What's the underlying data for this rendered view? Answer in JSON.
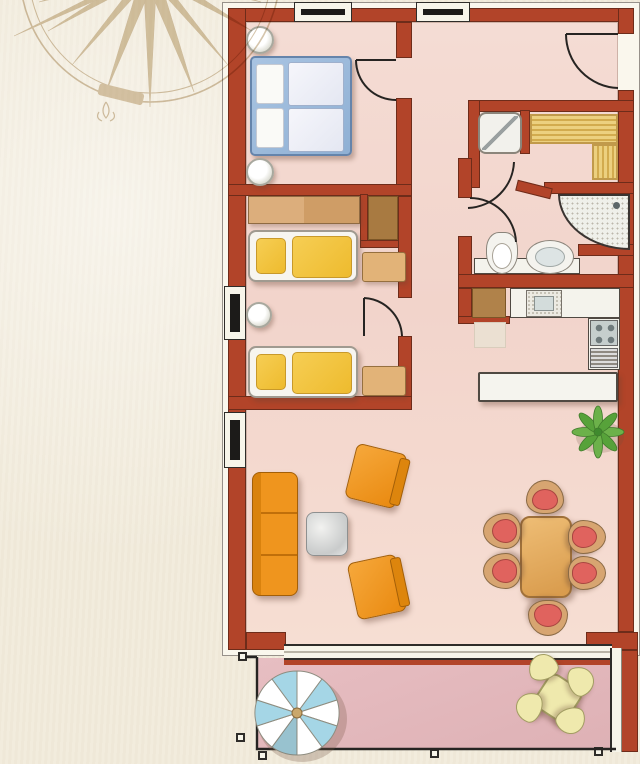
{
  "palette": {
    "wall": "#b24429",
    "floor": "#f3d8d0",
    "terrace": "#e3b7ba",
    "paper": "#f2ecdd",
    "orange": "#ef951e",
    "yellow": "#f2c544",
    "bedblue": "#9cb9d9",
    "wood": "#d7a571",
    "closet": "#a87a41",
    "chairred": "#e0635e",
    "plantgreen": "#68b148",
    "pale": "#efe9ad",
    "umbrellablue": "#a5d6e6",
    "silver": "#d9dadb",
    "compass": "#c0a678"
  },
  "items": [
    {
      "n": "plan-mat",
      "t": "mat",
      "x": 222,
      "y": 2,
      "w": 418,
      "h": 654
    },
    {
      "n": "main-floor",
      "t": "floor",
      "x": 246,
      "y": 22,
      "w": 372,
      "h": 626
    },
    {
      "n": "terrace-floor",
      "t": "terrace",
      "x": 256,
      "y": 658,
      "w": 358,
      "h": 92
    },
    {
      "n": "top-wall",
      "t": "wall",
      "x": 228,
      "y": 8,
      "w": 406,
      "h": 14
    },
    {
      "n": "left-wall",
      "t": "wall",
      "x": 228,
      "y": 8,
      "w": 18,
      "h": 642
    },
    {
      "n": "right-wall-top",
      "t": "wall",
      "x": 618,
      "y": 8,
      "w": 16,
      "h": 26
    },
    {
      "n": "right-wall",
      "t": "wall",
      "x": 618,
      "y": 90,
      "w": 16,
      "h": 542
    },
    {
      "n": "bottom-wall-left",
      "t": "wall",
      "x": 246,
      "y": 632,
      "w": 40,
      "h": 18
    },
    {
      "n": "bottom-wall-right",
      "t": "wall",
      "x": 586,
      "y": 632,
      "w": 52,
      "h": 18
    },
    {
      "n": "terrace-right-wall",
      "t": "wall",
      "x": 620,
      "y": 650,
      "w": 18,
      "h": 102
    },
    {
      "n": "bedroom1-right-wall-a",
      "t": "wall",
      "x": 396,
      "y": 22,
      "w": 16,
      "h": 36
    },
    {
      "n": "bedroom1-right-wall-b",
      "t": "wall",
      "x": 396,
      "y": 98,
      "w": 16,
      "h": 90
    },
    {
      "n": "bedroom-divider-wall",
      "t": "wall",
      "x": 228,
      "y": 184,
      "w": 184,
      "h": 12
    },
    {
      "n": "closet-wall-left",
      "t": "wall",
      "x": 360,
      "y": 194,
      "w": 8,
      "h": 54
    },
    {
      "n": "closet-wall-bottom",
      "t": "wall",
      "x": 360,
      "y": 240,
      "w": 50,
      "h": 8
    },
    {
      "n": "bedroom2-right-wall-a",
      "t": "wall",
      "x": 398,
      "y": 196,
      "w": 14,
      "h": 102
    },
    {
      "n": "bedroom2-right-wall-b",
      "t": "wall",
      "x": 398,
      "y": 336,
      "w": 14,
      "h": 62
    },
    {
      "n": "bedroom-bottom-wall",
      "t": "wall",
      "x": 228,
      "y": 396,
      "w": 184,
      "h": 14
    },
    {
      "n": "sauna-top-wall",
      "t": "wall",
      "x": 468,
      "y": 100,
      "w": 166,
      "h": 12
    },
    {
      "n": "sauna-left-wall",
      "t": "wall",
      "x": 468,
      "y": 100,
      "w": 12,
      "h": 88
    },
    {
      "n": "sauna-niche-wall",
      "t": "wall",
      "x": 520,
      "y": 110,
      "w": 10,
      "h": 44
    },
    {
      "n": "sauna-bottom-wall",
      "t": "wall",
      "x": 544,
      "y": 182,
      "w": 90,
      "h": 12
    },
    {
      "n": "sauna-diagonal-wall",
      "t": "wall",
      "x": 516,
      "y": 184,
      "w": 36,
      "h": 11,
      "r": 14
    },
    {
      "n": "bath-left-wall-a",
      "t": "wall",
      "x": 458,
      "y": 158,
      "w": 14,
      "h": 40
    },
    {
      "n": "bath-left-wall-b",
      "t": "wall",
      "x": 458,
      "y": 236,
      "w": 14,
      "h": 52
    },
    {
      "n": "shower-stub-wall",
      "t": "wall",
      "x": 578,
      "y": 244,
      "w": 56,
      "h": 12
    },
    {
      "n": "bath-bottom-wall",
      "t": "wall",
      "x": 458,
      "y": 274,
      "w": 176,
      "h": 14
    },
    {
      "n": "kitchen-left-wall",
      "t": "wall",
      "x": 458,
      "y": 288,
      "w": 14,
      "h": 36
    },
    {
      "n": "kitchen-stub-wall",
      "t": "wall",
      "x": 458,
      "y": 316,
      "w": 52,
      "h": 8
    },
    {
      "n": "top-window-1",
      "t": "winh",
      "x": 294,
      "y": 2,
      "w": 58,
      "h": 20
    },
    {
      "n": "top-window-2",
      "t": "winh",
      "x": 416,
      "y": 2,
      "w": 54,
      "h": 20
    },
    {
      "n": "left-window-1",
      "t": "winv",
      "x": 224,
      "y": 286,
      "w": 22,
      "h": 54
    },
    {
      "n": "left-window-2",
      "t": "winv",
      "x": 224,
      "y": 412,
      "w": 22,
      "h": 56
    },
    {
      "n": "patio-door-threshold",
      "t": "thresh",
      "x": 284,
      "y": 644,
      "w": 328,
      "h": 16
    },
    {
      "n": "patio-door-redline",
      "t": "redline",
      "x": 284,
      "y": 660,
      "w": 332,
      "h": 5
    },
    {
      "n": "terrace-white-strip",
      "t": "wstrip",
      "x": 610,
      "y": 648,
      "w": 12,
      "h": 104
    },
    {
      "n": "railing-post",
      "t": "post",
      "x": 238,
      "y": 652,
      "w": 9,
      "h": 9
    },
    {
      "n": "railing-post",
      "t": "post",
      "x": 236,
      "y": 733,
      "w": 9,
      "h": 9
    },
    {
      "n": "railing-post",
      "t": "post",
      "x": 258,
      "y": 751,
      "w": 9,
      "h": 9
    },
    {
      "n": "railing-post",
      "t": "post",
      "x": 430,
      "y": 749,
      "w": 9,
      "h": 9
    },
    {
      "n": "railing-post",
      "t": "post",
      "x": 594,
      "y": 747,
      "w": 9,
      "h": 9
    },
    {
      "n": "nightstand-lamp-1",
      "t": "lamp",
      "x": 246,
      "y": 26,
      "w": 28,
      "h": 28
    },
    {
      "n": "double-bed",
      "t": "bed",
      "x": 250,
      "y": 56,
      "w": 102,
      "h": 100
    },
    {
      "n": "bed-pillow-1",
      "t": "pillow",
      "x": 256,
      "y": 64,
      "w": 28,
      "h": 40
    },
    {
      "n": "bed-pillow-2",
      "t": "pillow",
      "x": 256,
      "y": 108,
      "w": 28,
      "h": 40
    },
    {
      "n": "bed-duvet-1",
      "t": "duvetw",
      "x": 288,
      "y": 62,
      "w": 56,
      "h": 44
    },
    {
      "n": "bed-duvet-2",
      "t": "duvetw",
      "x": 288,
      "y": 108,
      "w": 56,
      "h": 44
    },
    {
      "n": "nightstand-lamp-2",
      "t": "lamp",
      "x": 246,
      "y": 158,
      "w": 28,
      "h": 28
    },
    {
      "n": "wardrobe",
      "t": "wood",
      "x": 248,
      "y": 196,
      "w": 112,
      "h": 28
    },
    {
      "n": "builtin-closet",
      "t": "closet",
      "x": 368,
      "y": 196,
      "w": 30,
      "h": 44
    },
    {
      "n": "single-bed-1",
      "t": "bedbase",
      "x": 248,
      "y": 230,
      "w": 110,
      "h": 52
    },
    {
      "n": "single-bed-1-pillow",
      "t": "duvy",
      "x": 256,
      "y": 238,
      "w": 30,
      "h": 36
    },
    {
      "n": "single-bed-1-duvet",
      "t": "duvy",
      "x": 292,
      "y": 236,
      "w": 60,
      "h": 42
    },
    {
      "n": "bench-1",
      "t": "bench",
      "x": 362,
      "y": 252,
      "w": 44,
      "h": 30
    },
    {
      "n": "round-stool",
      "t": "stool",
      "x": 246,
      "y": 302,
      "w": 26,
      "h": 26
    },
    {
      "n": "single-bed-2",
      "t": "bedbase",
      "x": 248,
      "y": 346,
      "w": 110,
      "h": 52
    },
    {
      "n": "single-bed-2-pillow",
      "t": "duvy",
      "x": 256,
      "y": 354,
      "w": 30,
      "h": 36
    },
    {
      "n": "single-bed-2-duvet",
      "t": "duvy",
      "x": 292,
      "y": 352,
      "w": 60,
      "h": 42
    },
    {
      "n": "bench-2",
      "t": "bench",
      "x": 362,
      "y": 366,
      "w": 44,
      "h": 30
    },
    {
      "n": "sauna-shower",
      "t": "showersq",
      "x": 478,
      "y": 112,
      "w": 44,
      "h": 42
    },
    {
      "n": "sauna-bench-top",
      "t": "sbenchh",
      "x": 530,
      "y": 114,
      "w": 88,
      "h": 30
    },
    {
      "n": "sauna-bench-right",
      "t": "sbenchv",
      "x": 592,
      "y": 144,
      "w": 26,
      "h": 36
    },
    {
      "n": "bath-counter",
      "t": "counter",
      "x": 474,
      "y": 258,
      "w": 106,
      "h": 16
    },
    {
      "n": "corner-shower",
      "t": "cshower",
      "x": 558,
      "y": 194,
      "w": 72,
      "h": 56
    },
    {
      "n": "toilet",
      "t": "toilet",
      "x": 486,
      "y": 232,
      "w": 32,
      "h": 42
    },
    {
      "n": "washbasin",
      "t": "sinko",
      "x": 526,
      "y": 240,
      "w": 48,
      "h": 34
    },
    {
      "n": "fridge",
      "t": "fridge",
      "x": 472,
      "y": 288,
      "w": 34,
      "h": 30
    },
    {
      "n": "kitchen-rug",
      "t": "rug",
      "x": 474,
      "y": 322,
      "w": 32,
      "h": 26
    },
    {
      "n": "kitchen-counter",
      "t": "counter",
      "x": 510,
      "y": 288,
      "w": 110,
      "h": 30
    },
    {
      "n": "kitchen-sink",
      "t": "speckle",
      "x": 526,
      "y": 290,
      "w": 36,
      "h": 27
    },
    {
      "n": "kitchen-unit",
      "t": "counter",
      "x": 588,
      "y": 318,
      "w": 32,
      "h": 52
    },
    {
      "n": "stove",
      "t": "stove",
      "x": 590,
      "y": 320,
      "w": 28,
      "h": 26
    },
    {
      "n": "oven",
      "t": "striped",
      "x": 590,
      "y": 348,
      "w": 28,
      "h": 20
    },
    {
      "n": "kitchen-island",
      "t": "island",
      "x": 478,
      "y": 372,
      "w": 140,
      "h": 30
    },
    {
      "n": "sofa",
      "t": "sofa",
      "x": 252,
      "y": 472,
      "w": 46,
      "h": 124
    },
    {
      "n": "coffee-table",
      "t": "ctable",
      "x": 306,
      "y": 512,
      "w": 42,
      "h": 44
    },
    {
      "n": "armchair-1",
      "t": "armchair",
      "x": 350,
      "y": 448,
      "w": 52,
      "h": 56,
      "r": 14
    },
    {
      "n": "armchair-2",
      "t": "armchair",
      "x": 352,
      "y": 558,
      "w": 50,
      "h": 58,
      "r": -12
    },
    {
      "n": "dining-table",
      "t": "dtable",
      "x": 520,
      "y": 516,
      "w": 52,
      "h": 82
    },
    {
      "n": "dining-chair-north",
      "t": "chair",
      "x": 526,
      "y": 480,
      "w": 38,
      "h": 34,
      "r": 0
    },
    {
      "n": "dining-chair-south",
      "t": "chair",
      "x": 528,
      "y": 600,
      "w": 40,
      "h": 36,
      "r": 180
    },
    {
      "n": "dining-chair-west-1",
      "t": "chair",
      "x": 484,
      "y": 512,
      "w": 36,
      "h": 38,
      "r": -90
    },
    {
      "n": "dining-chair-west-2",
      "t": "chair",
      "x": 484,
      "y": 552,
      "w": 36,
      "h": 38,
      "r": -90
    },
    {
      "n": "dining-chair-east-1",
      "t": "chair",
      "x": 570,
      "y": 518,
      "w": 34,
      "h": 38,
      "r": 90
    },
    {
      "n": "dining-chair-east-2",
      "t": "chair",
      "x": 570,
      "y": 554,
      "w": 34,
      "h": 38,
      "r": 90
    },
    {
      "n": "patio-table",
      "t": "ttable",
      "x": 538,
      "y": 678,
      "w": 40,
      "h": 40,
      "r": 33
    },
    {
      "n": "patio-stool-1",
      "t": "tstool",
      "x": 528,
      "y": 654,
      "w": 30,
      "h": 26,
      "r": -20
    },
    {
      "n": "patio-stool-2",
      "t": "tstool",
      "x": 566,
      "y": 668,
      "w": 30,
      "h": 26,
      "r": 70
    },
    {
      "n": "patio-stool-3",
      "t": "tstool",
      "x": 514,
      "y": 694,
      "w": 30,
      "h": 26,
      "r": -70
    },
    {
      "n": "patio-stool-4",
      "t": "tstool",
      "x": 556,
      "y": 708,
      "w": 30,
      "h": 26,
      "r": 160
    }
  ]
}
